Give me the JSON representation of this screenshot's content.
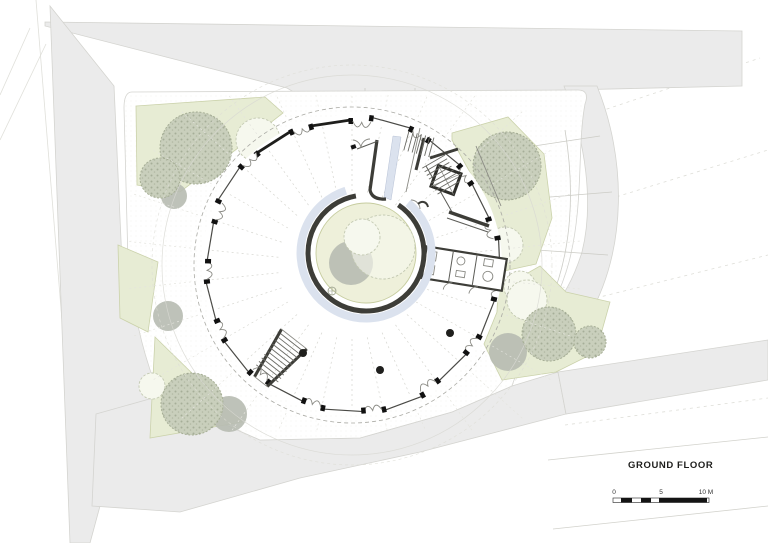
{
  "drawing": {
    "title": "GROUND FLOOR",
    "scale_bar": {
      "labels": [
        "0",
        "5",
        "10 M"
      ]
    },
    "colors": {
      "road": "#ebebeb",
      "road_edge": "#d4d4d0",
      "green": "#e7ecd4",
      "green_edge": "#cbd2ab",
      "tree": "#c9cfbc",
      "tree_outline": "#f6f8ee",
      "tree_shadow": "#b7bbb1",
      "wall": "#3d3d38",
      "glass": "#dbe2ee",
      "courtyard": "#eef0da",
      "black": "#141414"
    }
  }
}
